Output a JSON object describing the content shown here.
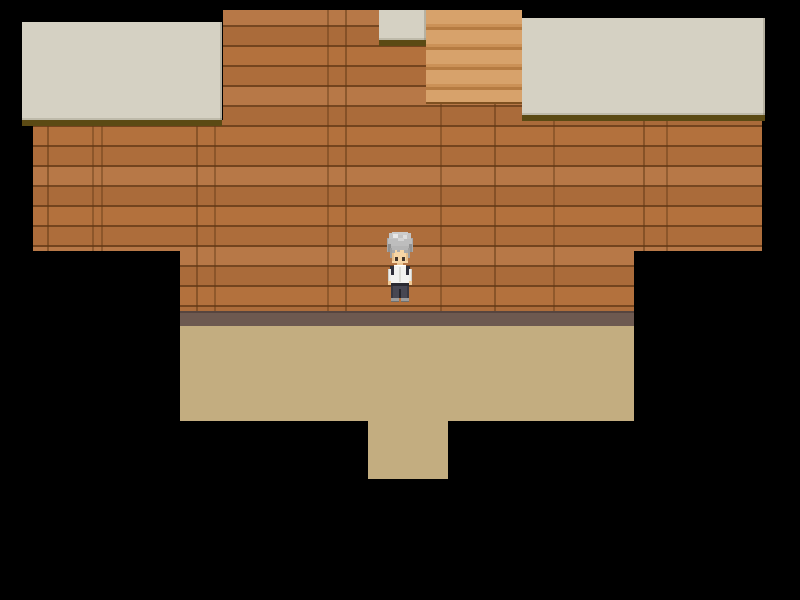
{
  "scene": {
    "title": "rpg-room-interior",
    "description": "Top-down RPG room: brick wall, roof panels, staircase, tan floor with doorway, player character standing at wall",
    "visible_text": ""
  },
  "colors": {
    "bg": "#000000",
    "brick": "#b3713d",
    "brick_seam": "#60371a",
    "roof": "#d5d1c3",
    "roof_shadow": "#5b4a14",
    "stairs": "#d19a62",
    "stairs_step_shade": "#b57b42",
    "stairs_edge": "#7e5020",
    "baseboard": "#6d5950",
    "baseboard_edge": "#57453f",
    "floor": "#c3ad80",
    "hair": "#bdbdbd",
    "hair_highlight": "#e8e8e8",
    "hair_shadow": "#8f8f8f",
    "skin": "#f6d5a5",
    "shirt": "#f3f3f0",
    "strap": "#30303a",
    "pants": "#474752",
    "shoes": "#9c9c9c",
    "eyes": "#43362c"
  },
  "regions": {
    "viewport": {
      "x": 0,
      "y": 0,
      "w": 800,
      "h": 600
    },
    "roof_left": {
      "x": 22,
      "y": 22,
      "w": 200,
      "h": 98
    },
    "roof_left_shadow": {
      "x": 22,
      "y": 120,
      "w": 200,
      "h": 6
    },
    "roof_small": {
      "x": 379,
      "y": 10,
      "w": 47,
      "h": 30
    },
    "roof_small_shadow": {
      "x": 379,
      "y": 40,
      "w": 47,
      "h": 6
    },
    "roof_right": {
      "x": 522,
      "y": 18,
      "w": 243,
      "h": 97
    },
    "roof_right_shadow": {
      "x": 522,
      "y": 115,
      "w": 243,
      "h": 6
    },
    "stairs": {
      "x": 426,
      "y": 10,
      "w": 96,
      "h": 94
    },
    "baseboard": {
      "x": 180,
      "y": 311,
      "w": 454,
      "h": 15
    },
    "floor_main": {
      "x": 180,
      "y": 326,
      "w": 454,
      "h": 95
    },
    "floor_doorway": {
      "x": 368,
      "y": 421,
      "w": 80,
      "h": 58
    },
    "character": {
      "x": 385,
      "y": 232,
      "w": 30,
      "h": 71
    }
  },
  "wall_polygon": [
    [
      223,
      10
    ],
    [
      522,
      10
    ],
    [
      522,
      120
    ],
    [
      762,
      120
    ],
    [
      762,
      251
    ],
    [
      634,
      251
    ],
    [
      634,
      311
    ],
    [
      180,
      311
    ],
    [
      180,
      251
    ],
    [
      33,
      251
    ],
    [
      33,
      120
    ],
    [
      223,
      120
    ]
  ],
  "character": {
    "role": "player-character",
    "appearance": "gray tousled hair, white shirt with dark shoulder straps, dark gray pants, gray shoes, facing down"
  }
}
